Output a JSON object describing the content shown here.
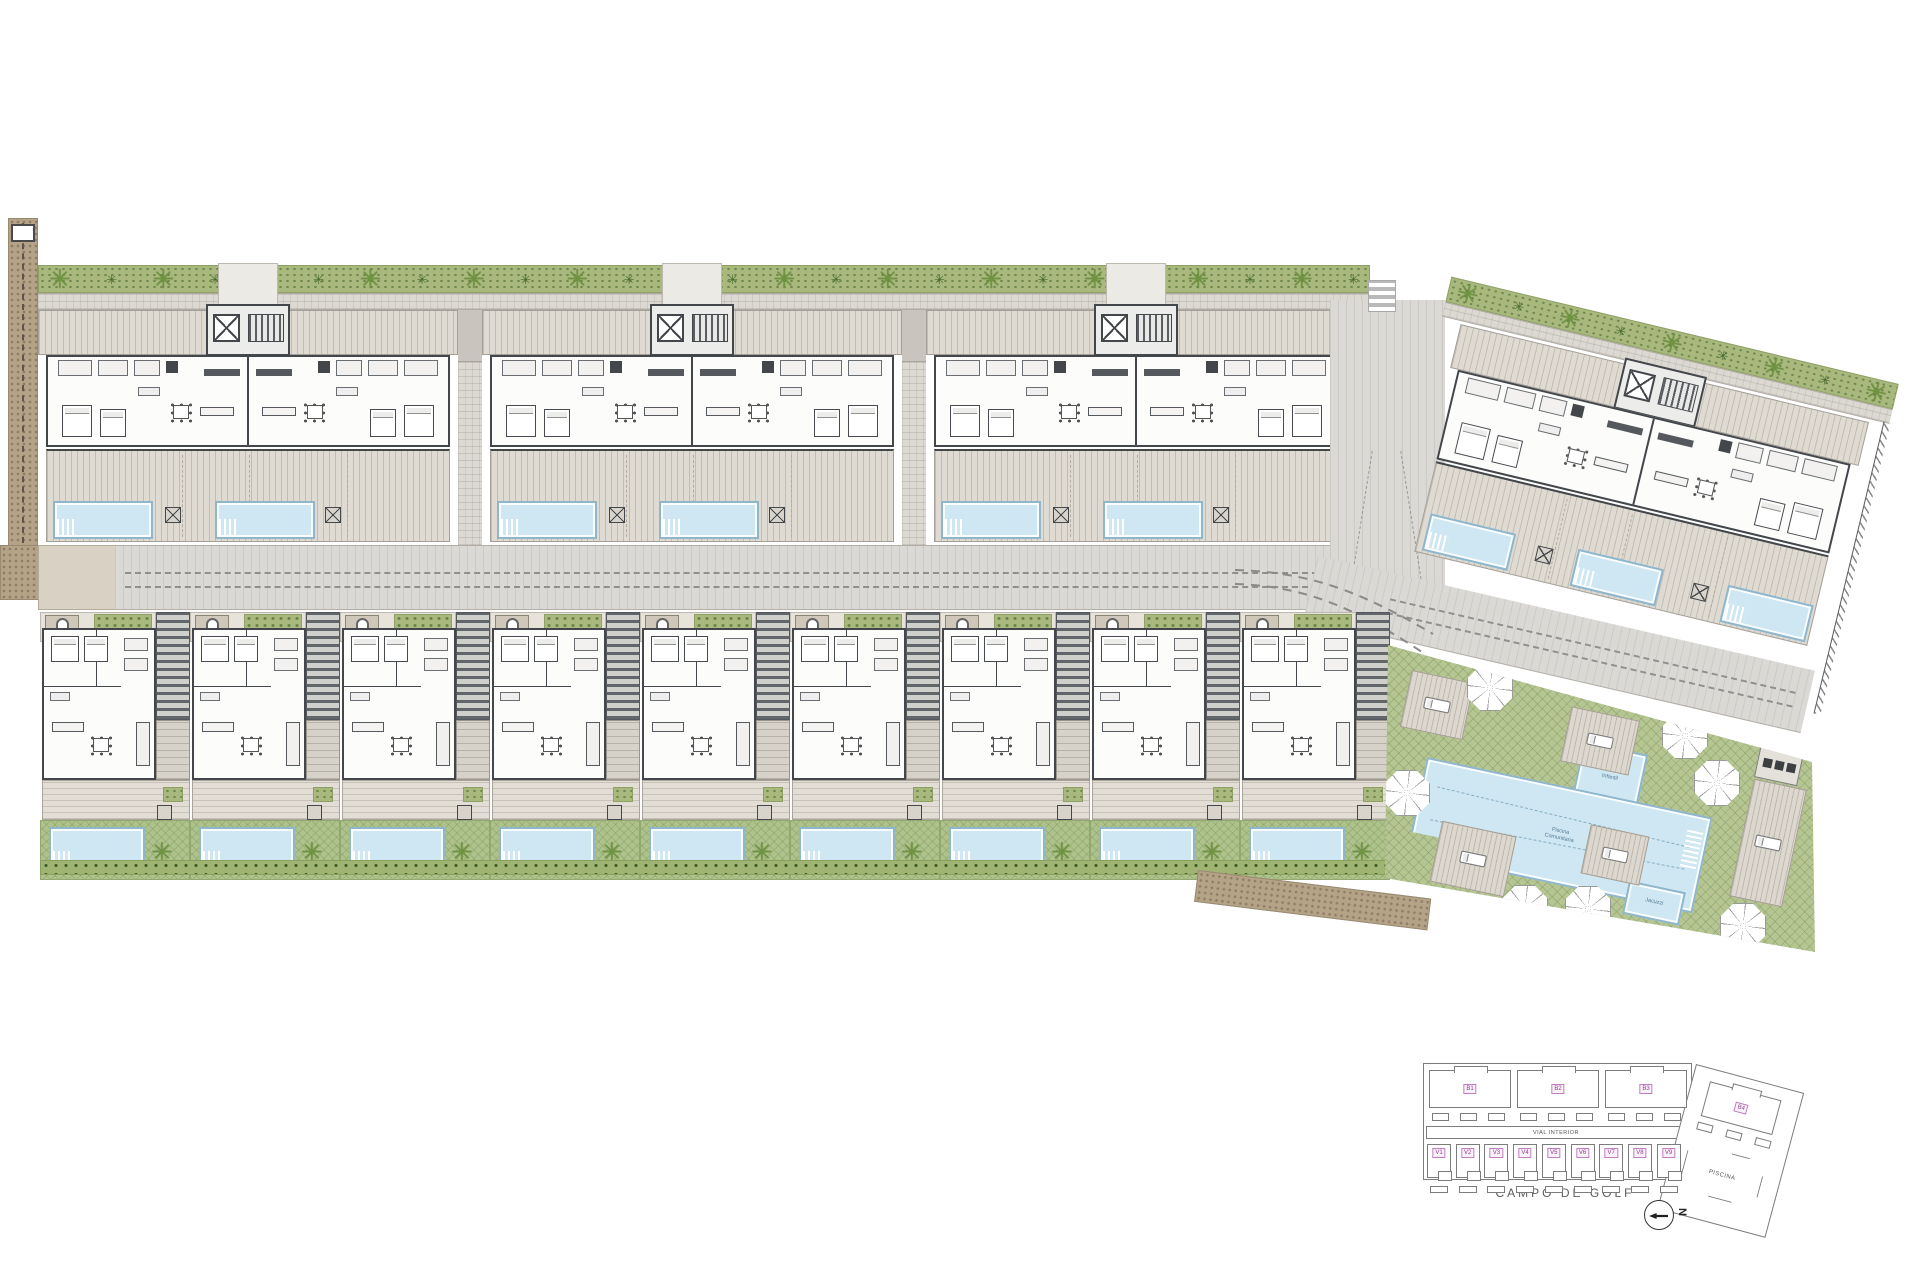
{
  "keyplan": {
    "vial_label": "VIAL INTERIOR",
    "golf_label": "CAMPO DE GOLF",
    "piscina_label": "PISCINA",
    "north_label": "N",
    "blocks": [
      {
        "id": "B1"
      },
      {
        "id": "B2"
      },
      {
        "id": "B3"
      }
    ],
    "block4": {
      "id": "B4"
    },
    "villas": [
      {
        "id": "V1"
      },
      {
        "id": "V2"
      },
      {
        "id": "V3"
      },
      {
        "id": "V4"
      },
      {
        "id": "V5"
      },
      {
        "id": "V6"
      },
      {
        "id": "V7"
      },
      {
        "id": "V8"
      },
      {
        "id": "V9"
      }
    ]
  },
  "amenity": {
    "main_pool_label": "Piscina\nComunitaria",
    "kids_pool_label": "Piscina\nInfantil",
    "spa_label": "Jacuzzi"
  },
  "palette": {
    "water": "#cfe7f2",
    "water_line": "#8fb6cb",
    "lawn": "#b6c693",
    "deck": "#dfdbd3",
    "road": "#dbd9d5",
    "wall": "#43474b",
    "hedge": "#a9b97e",
    "palm": "#6f9440",
    "path_brown": "#b5a388",
    "keyplan_line": "#7c7c7c",
    "label_pink": "#93368f"
  },
  "icons": {
    "palm": "palm-icon",
    "bush": "bush-icon",
    "parasol": "parasol-icon",
    "lounger": "sun-lounger",
    "elevator": "elevator-icon",
    "stairs": "stairs-icon",
    "bathtub": "bathtub-icon",
    "north_arrow": "north-arrow-icon"
  }
}
